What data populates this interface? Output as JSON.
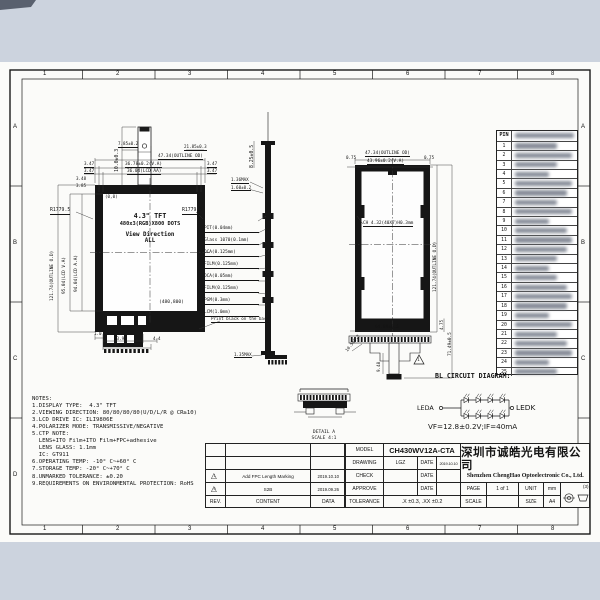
{
  "sheet": {
    "zone_cols": [
      "1",
      "2",
      "3",
      "4",
      "5",
      "6",
      "7",
      "8"
    ],
    "zone_rows": [
      "A",
      "B",
      "C",
      "D"
    ]
  },
  "front": {
    "lcd_lines": [
      "4.3\" TFT",
      "480x3(RGB)X800 DOTS",
      "View Direction",
      "ALL"
    ],
    "origin": "(0,0)",
    "endpoint": "(480,800)",
    "print_note": "Print black on the back",
    "dims": {
      "fpc_len": "10.0±0.3",
      "fpc_w": "7.85±0.2",
      "fpc_off": "21.85±0.3",
      "outline_w": "47.34(OUTLINE OD)",
      "va_w": "36.78±0.2(V.A)",
      "aa_w": "36.04(LCD AA)",
      "ml1": "3.47",
      "ml2": "3.47",
      "mr1": "3.47",
      "mr2": "3.47",
      "mt1": "3.48",
      "mt2": "3.85",
      "outline_h": "121.74(OUTLINE O.D)",
      "va_h": "95.04(LCD V.A)",
      "aa_h": "94.04(LCD A.A)",
      "r_left": "R1779.5",
      "r_right": "R1779.5",
      "b1": "1.0",
      "b2": "13.9",
      "b3": "16.9",
      "b4": "4.4"
    }
  },
  "side": {
    "layers": [
      "PIT(0.04mm)",
      "Glass 1070(0.1mm)",
      "OCA(0.125mm)",
      "FILM(0.125mm)",
      "OCA(0.05mm)",
      "FILM(0.125mm)",
      "PGM(0.3mm)",
      "LCM(1.0mm)"
    ],
    "dims": {
      "top": "8.25±0.5",
      "m1": "1.36MAX",
      "m2": "1.60±0.2",
      "bot": "1.35MAX"
    }
  },
  "back": {
    "chip_label": "CH 4.32(40X7)H0.3mm",
    "dims": {
      "outline_w": "47.34(OUTLINE OD)",
      "va_w": "43.96±0.2(V.A)",
      "m_l": "0.75",
      "m_r": "0.75",
      "outline_h": "121.74(OUTLINE O.D)",
      "fpc_h": "71.49±0.5",
      "m_b": "4.75",
      "finger_w": "64.89±0.5",
      "tail": "9.48",
      "tail_w": "10.5±0.3",
      "rev_mark": "1"
    }
  },
  "pins": {
    "header": "PIN",
    "numbers": [
      "1",
      "2",
      "3",
      "4",
      "5",
      "6",
      "7",
      "8",
      "9",
      "10",
      "11",
      "12",
      "13",
      "14",
      "15",
      "16",
      "17",
      "18",
      "19",
      "20",
      "21",
      "22",
      "23",
      "24",
      "25"
    ]
  },
  "bl": {
    "title": "BL CIRCUIT DIAGRAM:",
    "anode": "LEDA",
    "cathode": "LEDK",
    "spec": "VF=12.8±0.2V;IF=40mA"
  },
  "detail": {
    "name": "DETAIL A",
    "scale": "SCALE 4:1"
  },
  "notes": {
    "lines": [
      "NOTES:",
      "1.DISPLAY TYPE:  4.3\" TFT",
      "2.VIEWING DIRECTION: 80/80/80/80(U/D/L/R @ CR≥10)",
      "3.LCD DRIVE IC: ILI9806E",
      "4.POLARIZER MODE: TRANSMISSIVE/NEGATIVE",
      "5.CTP NOTE:",
      "  LENS+ITO Film+ITO Film+FPC+adhesive",
      "  LENS GLASS: 1.1mm",
      "  IC: GT911",
      "6.OPERATING TEMP: -10° C~+60° C",
      "7.STORAGE TEMP: -20° C~+70° C",
      "8.UNMARKED TOLERANCE: ±0.20",
      "9.REQUIREMENTS ON ENVIRONMENTAL PROTECTION: RoHS"
    ]
  },
  "revisions": {
    "header": {
      "rev": "REV.",
      "content": "CONTENT",
      "date": "DATA"
    },
    "rows": [
      {
        "mark": "1",
        "content": "Add FPC Length Marking",
        "date": "2019.10.10"
      },
      {
        "mark": "0",
        "content": "S2B",
        "date": "2019.09.26"
      }
    ]
  },
  "title_block": {
    "model_label": "MODEL",
    "model": "CH430WV12A-CTA",
    "drawing_label": "DRAWING",
    "drawing": "LGZ",
    "date_label": "DATE",
    "drawing_date": "2019.10.10",
    "check_label": "CHECK",
    "approve_label": "APPROVE",
    "tolerance_label": "TOLERANCE",
    "tolerance": ".X ±0.3, .XX ±0.2",
    "page_label": "PAGE",
    "page": "1 of 1",
    "unit_label": "UNIT",
    "unit": "mm",
    "scale_label": "SCALE",
    "size_label": "SIZE",
    "size": "A4",
    "company_cn": "深圳市诚皓光电有限公司",
    "company_en": "Shenzhen ChengHao Optoelectronic Co., Ltd.",
    "angle_note": "(3)"
  }
}
